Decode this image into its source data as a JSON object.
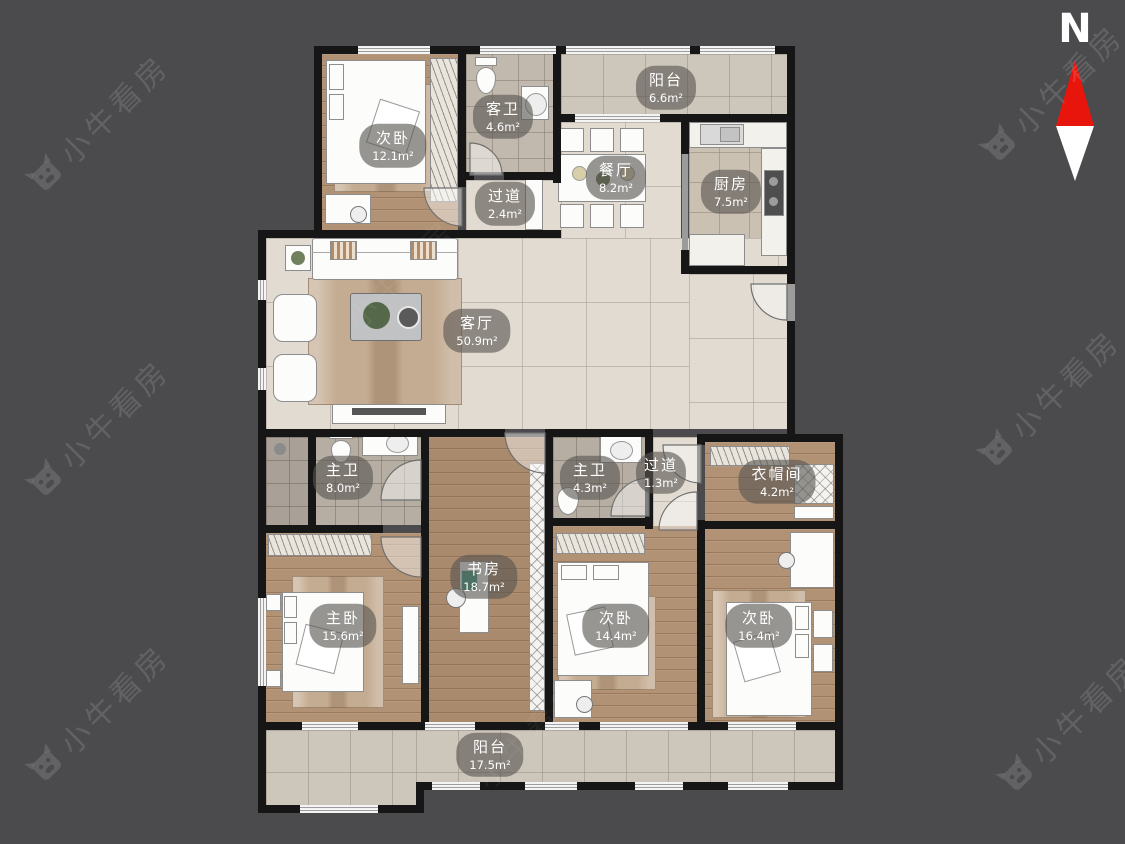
{
  "watermark": {
    "text": "小牛看房"
  },
  "compass": {
    "label": "N"
  },
  "rooms": [
    {
      "id": "bedroom-top-left",
      "name": "次卧",
      "area": "12.1m²"
    },
    {
      "id": "guest-bathroom",
      "name": "客卫",
      "area": "4.6m²"
    },
    {
      "id": "balcony-top",
      "name": "阳台",
      "area": "6.6m²"
    },
    {
      "id": "dining-room",
      "name": "餐厅",
      "area": "8.2m²"
    },
    {
      "id": "kitchen",
      "name": "厨房",
      "area": "7.5m²"
    },
    {
      "id": "hallway-top",
      "name": "过道",
      "area": "2.4m²"
    },
    {
      "id": "living-room",
      "name": "客厅",
      "area": "50.9m²"
    },
    {
      "id": "master-bathroom",
      "name": "主卫",
      "area": "8.0m²"
    },
    {
      "id": "master-bathroom-2",
      "name": "主卫",
      "area": "4.3m²"
    },
    {
      "id": "hallway-small",
      "name": "过道",
      "area": "1.3m²"
    },
    {
      "id": "cloakroom",
      "name": "衣帽间",
      "area": "4.2m²"
    },
    {
      "id": "study",
      "name": "书房",
      "area": "18.7m²"
    },
    {
      "id": "master-bedroom",
      "name": "主卧",
      "area": "15.6m²"
    },
    {
      "id": "bedroom-2",
      "name": "次卧",
      "area": "14.4m²"
    },
    {
      "id": "bedroom-3",
      "name": "次卧",
      "area": "16.4m²"
    },
    {
      "id": "balcony-bottom",
      "name": "阳台",
      "area": "17.5m²"
    }
  ],
  "colors": {
    "background": "#4b4b4d",
    "wall": "#161616",
    "compass_north": "#e8150d",
    "wood_floor": "#b19275",
    "tile_floor": "#e1dbd2",
    "label_pill": "rgba(88,85,80,0.62)"
  }
}
